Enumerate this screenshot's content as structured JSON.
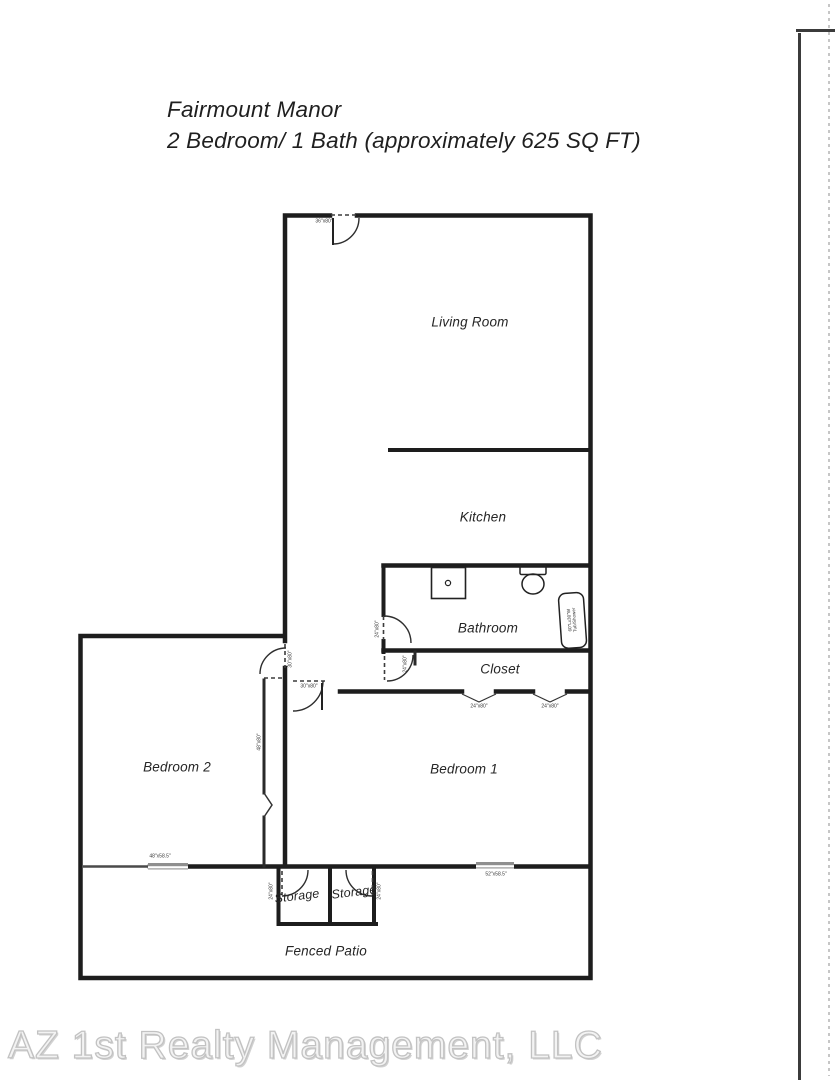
{
  "header": {
    "title_line1": "Fairmount Manor",
    "title_line2": "2 Bedroom/ 1 Bath (approximately 625 SQ FT)"
  },
  "rooms": {
    "living_room": "Living Room",
    "kitchen": "Kitchen",
    "bathroom": "Bathroom",
    "closet": "Closet",
    "bedroom_2": "Bedroom 2",
    "bedroom_1": "Bedroom 1",
    "storage_1": "Storage",
    "storage_2": "Storage",
    "fenced_patio": "Fenced Patio"
  },
  "fixtures": {
    "tub_line1": "60\"Lx30\"W",
    "tub_line2": "Tub/Shower"
  },
  "dimensions": {
    "entry_door": "36\"x80\"",
    "bedroom_2_door": "30\"x80\"",
    "bedroom_1_door": "30\"x80\"",
    "bathroom_door": "24\"x80\"",
    "closet_left_door": "24\"x80\"",
    "closet_bifold_1": "24\"x80\"",
    "closet_bifold_2": "24\"x80\"",
    "bedroom_2_closet_door": "48\"x80\"",
    "bedroom_2_window": "48\"x58.5\"",
    "bedroom_1_window": "52\"x58.5\"",
    "storage_1_door": "24\"x80\"",
    "storage_2_door": "24\"x80\""
  },
  "footer": {
    "company": "AZ 1st Realty Management, LLC"
  },
  "colors": {
    "wall": "#1d1d1d",
    "window": "#8f8f8f",
    "footer_text": "#c9c9c9"
  }
}
